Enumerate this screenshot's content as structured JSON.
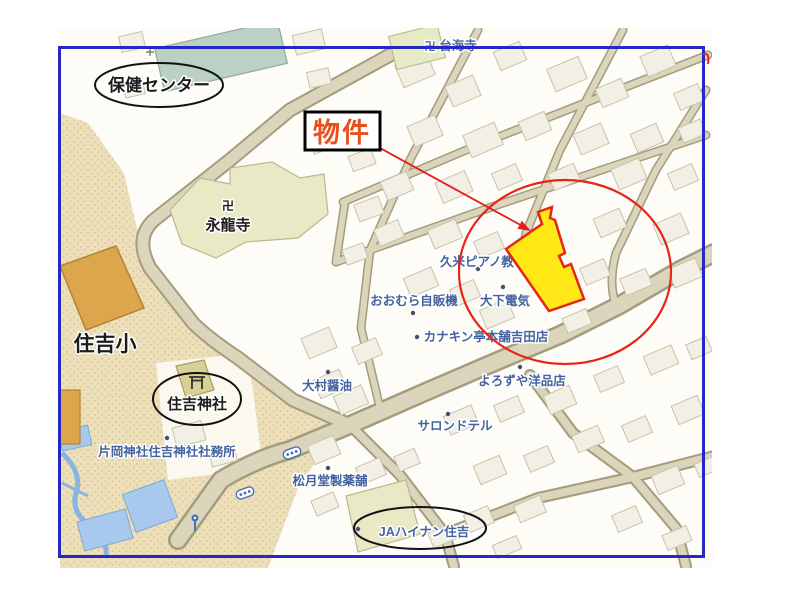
{
  "annotation": {
    "property_label": "物件"
  },
  "landmarks": {
    "health_center": "保健センター",
    "eiryuji_temple": "永龍寺",
    "manji_symbol": "卍",
    "sumiyoshi_elementary": "住吉小",
    "sumiyoshi_shrine": "住吉神社"
  },
  "pois": {
    "taikaiji_temple": "台海寺",
    "kume_piano": "久米ピアノ教",
    "omura_vending": "おおむら自販機",
    "oshita_denki": "大下電気",
    "kanakintei_yoshida": "カナキン亭本舗吉田店",
    "yorozuya_clothing": "よろずや洋品店",
    "omura_soy_sauce": "大村醤油",
    "salon_de_tel": "サロンドテル",
    "kataoka_shrine_office": "片岡神社住吉神社社務所",
    "shogetsudo_pharmacy": "松月堂製薬舗",
    "ja_hainan_sumiyoshi": "JAハイナン住吉"
  },
  "icons": {
    "manji": "卍",
    "torii": "torii-gate",
    "traffic_signal": "signal-dots",
    "street_lamp": "lamp"
  },
  "colors": {
    "highlight_fill": "#ffe815",
    "highlight_stroke": "#e62518",
    "annotation_red": "#e02020",
    "property_text_orange": "#e8511a",
    "frame_blue": "#2727c4",
    "poi_text_blue": "#44639e",
    "school_gold": "#dca74c",
    "health_center_teal": "#bad1c3",
    "temple_green": "#e9e9c6",
    "water_blue": "#a9c8ee"
  }
}
